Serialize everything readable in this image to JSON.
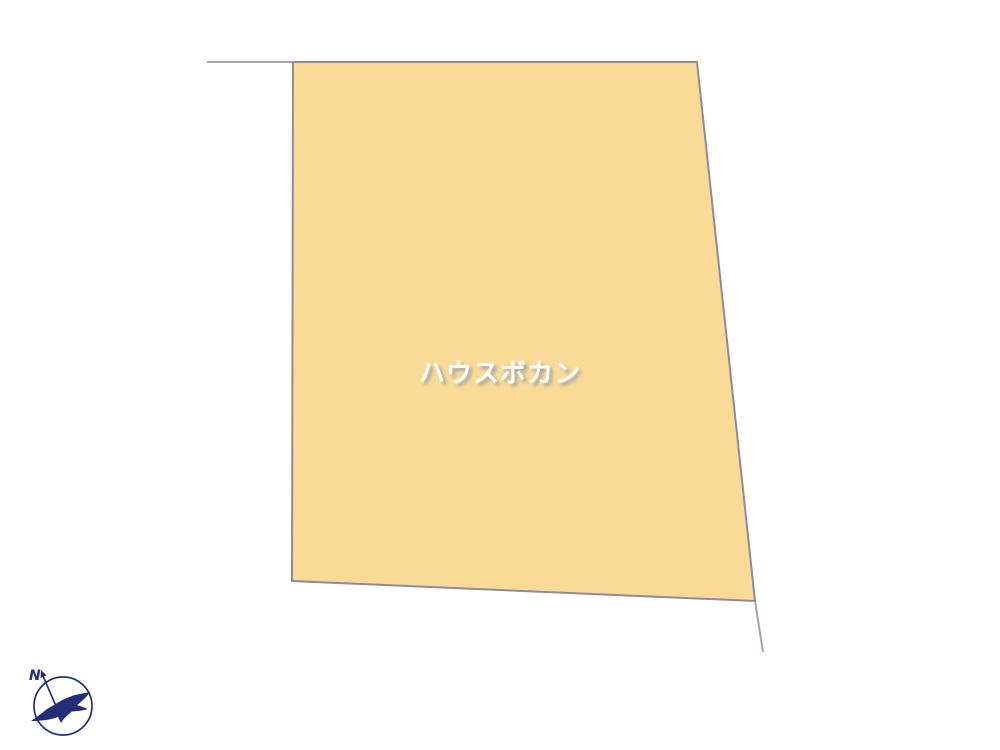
{
  "page": {
    "background_color": "#ffffff",
    "type_label": "land-plot-diagram"
  },
  "plot": {
    "polygon_points": "293,62 697,62 755,601 292,581",
    "fill_color": "#f9db97",
    "border_color": "#90899a",
    "extension_color": "#a2a2b8",
    "extension_lines": [
      {
        "x1": 207,
        "y1": 62,
        "x2": 293,
        "y2": 62
      },
      {
        "x1": 755,
        "y1": 601,
        "x2": 763,
        "y2": 652
      }
    ]
  },
  "watermark": {
    "text": "ハウスボカン",
    "color": "#ffffff",
    "shadow_color": "#a3a3a3"
  },
  "compass": {
    "north_label": "N",
    "color": "#242e78"
  }
}
